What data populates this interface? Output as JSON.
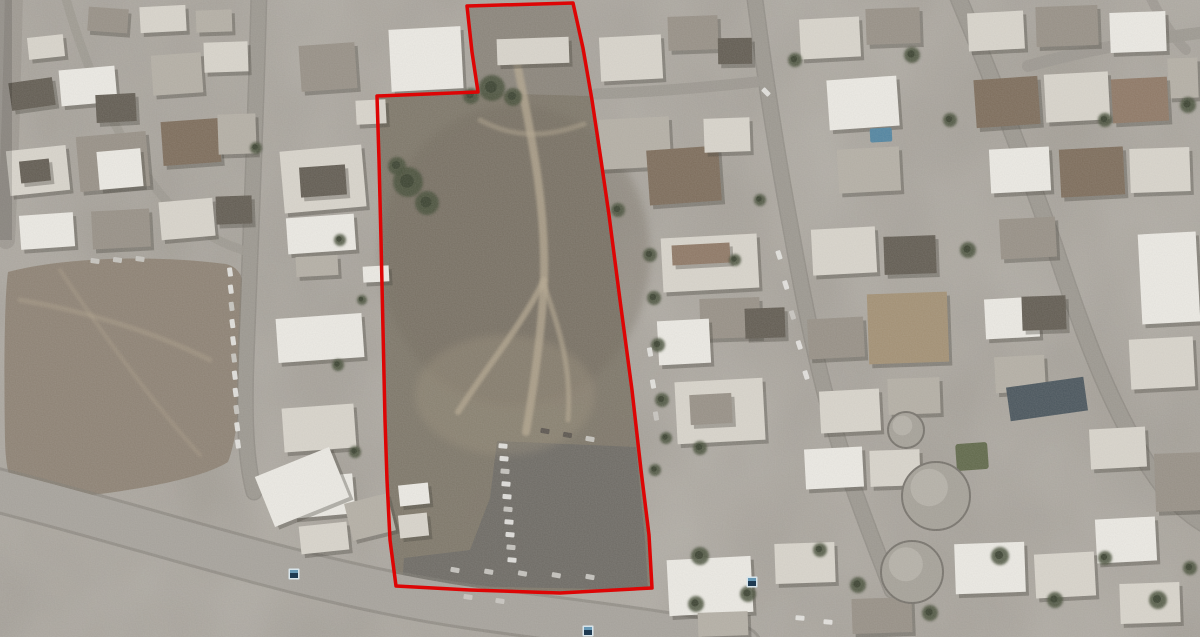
{
  "scene": {
    "width": 1200,
    "height": 637,
    "kind": "oblique-satellite-imagery",
    "palette": {
      "ground": "#a49f97",
      "road": "#9b978f",
      "road_big": "#a6a29b",
      "road_casing": "#7e7a73",
      "field": "#8c8072",
      "parcel": "#7a7265",
      "parcel_top": "#8b857b",
      "parking": "#6b6862",
      "dirt_path": "#b5a78f",
      "tree": "#434b36",
      "tree_core": "#353d2b",
      "shadow": "#3a362f",
      "w1": "#edebe5",
      "w2": "#d9d5cc",
      "g1": "#b4afa5",
      "g2": "#968f85",
      "d1": "#5f594f",
      "br": "#7b6a58",
      "br2": "#8d7663",
      "tan": "#a28f72",
      "car_light": "#e6e5e1",
      "car_mid": "#c9c7c2",
      "car_dark": "#55504a",
      "boundary_red": "#dd0505",
      "marker_fill": "#1e3a52",
      "marker_border": "#d8e4ea",
      "marker_highlight": "#6fa3c0",
      "pool_blue": "#4e83a0",
      "slate_roof": "#46525a",
      "green_patch": "#5d6647",
      "tank": "#a5a198",
      "tank_rim": "#75716a"
    },
    "boundary": {
      "name": "red-parcel-boundary",
      "stroke_width": 3.5,
      "points": [
        [
          467,
          6
        ],
        [
          573,
          3
        ],
        [
          583,
          48
        ],
        [
          592,
          100
        ],
        [
          601,
          160
        ],
        [
          609,
          215
        ],
        [
          620,
          300
        ],
        [
          632,
          390
        ],
        [
          641,
          470
        ],
        [
          649,
          535
        ],
        [
          652,
          588
        ],
        [
          560,
          593
        ],
        [
          470,
          590
        ],
        [
          396,
          586
        ],
        [
          390,
          540
        ],
        [
          387,
          480
        ],
        [
          385,
          420
        ],
        [
          383,
          330
        ],
        [
          381,
          240
        ],
        [
          379,
          160
        ],
        [
          377,
          96
        ],
        [
          478,
          92
        ],
        [
          472,
          52
        ]
      ]
    },
    "markers": [
      {
        "name": "placemark-1",
        "x": 294,
        "y": 574
      },
      {
        "name": "placemark-2",
        "x": 588,
        "y": 631
      },
      {
        "name": "placemark-3",
        "x": 752,
        "y": 582
      }
    ],
    "regions": [
      {
        "name": "dirt-field-left",
        "fill": "field",
        "opacity": 1,
        "path": "M8,272 C60,258 150,254 226,264 C242,268 246,282 245,310 C243,370 240,430 228,462 C200,480 120,494 40,500 C18,500 6,488 5,440 C4,380 4,300 8,272 Z"
      },
      {
        "name": "parcel-interior",
        "fill": "parcel",
        "opacity": 0.96,
        "path": "M467,6 L573,3 L583,48 L592,100 L601,160 L609,215 L620,300 L632,390 L641,470 L649,535 L652,588 L560,593 L470,590 L396,586 L390,540 L387,480 L385,420 L383,330 L381,240 L379,160 L377,96 L478,92 L472,52 Z"
      },
      {
        "name": "parcel-top-yard",
        "fill": "parcel_top",
        "opacity": 0.9,
        "path": "M468,7 L572,4 L590,96 L479,93 Z"
      },
      {
        "name": "parking-lot",
        "fill": "parking",
        "opacity": 1,
        "path": "M497,441 L636,447 L645,540 L648,590 L402,585 L404,558 L470,550 L490,498 Z"
      }
    ],
    "roads": [
      {
        "name": "left-edge-lane",
        "width": 18,
        "casing": 0,
        "opacity": 0.9,
        "path": "M14,-8 C12,80 10,160 6,240"
      },
      {
        "name": "left-street",
        "width": 14,
        "casing": 3,
        "opacity": 1,
        "path": "M259,-8 C256,120 250,250 246,360 C244,420 246,462 254,492"
      },
      {
        "name": "topleft-diagonal-street",
        "width": 9,
        "casing": 0,
        "opacity": 0.8,
        "path": "M64,-8 C86,70 120,150 170,205 C195,230 225,246 250,252"
      },
      {
        "name": "main-boulevard",
        "width": 40,
        "casing": 6,
        "opacity": 1,
        "big": true,
        "path": "M-12,488 C140,525 300,582 470,607 C580,623 660,630 740,648"
      },
      {
        "name": "center-right-street",
        "width": 14,
        "casing": 3,
        "opacity": 1,
        "path": "M754,-8 C764,70 776,150 792,235 C808,325 824,400 848,472 C862,514 876,548 892,590"
      },
      {
        "name": "cross-street",
        "width": 11,
        "casing": 0,
        "opacity": 0.95,
        "path": "M596,94 C648,92 700,88 756,82"
      },
      {
        "name": "far-right-street",
        "width": 15,
        "casing": 3,
        "opacity": 1,
        "path": "M956,-8 C992,78 1024,160 1054,245 C1082,330 1108,402 1150,468 C1168,496 1186,514 1208,526"
      },
      {
        "name": "topright-street",
        "width": 12,
        "casing": 0,
        "opacity": 0.95,
        "path": "M1028,66 C1086,50 1140,40 1208,32"
      },
      {
        "name": "topright-corner-lane",
        "width": 10,
        "casing": 0,
        "opacity": 0.85,
        "path": "M1148,-8 C1158,14 1170,34 1186,50"
      }
    ],
    "dirt_paths": [
      {
        "width": 8,
        "opacity": 0.75,
        "path": "M516,58 C530,130 546,200 544,280 C542,330 534,385 526,432"
      },
      {
        "width": 6,
        "opacity": 0.7,
        "path": "M544,280 C522,325 488,365 458,412"
      },
      {
        "width": 5,
        "opacity": 0.6,
        "path": "M544,285 C560,330 572,370 568,420"
      },
      {
        "width": 5,
        "opacity": 0.45,
        "path": "M480,120 C520,142 556,134 584,124"
      },
      {
        "width": 5,
        "opacity": 0.35,
        "path": "M20,300 C80,310 150,330 210,360"
      },
      {
        "width": 4,
        "opacity": 0.3,
        "path": "M60,270 C100,330 150,400 200,455"
      }
    ],
    "buildings": [
      [
        28,
        36,
        36,
        22,
        -6,
        "w2"
      ],
      [
        88,
        8,
        40,
        24,
        4,
        "g2"
      ],
      [
        140,
        6,
        46,
        26,
        -3,
        "w2"
      ],
      [
        196,
        10,
        36,
        22,
        -2,
        "g1"
      ],
      [
        10,
        80,
        44,
        28,
        -8,
        "d1"
      ],
      [
        60,
        68,
        56,
        36,
        -5,
        "w1"
      ],
      [
        96,
        94,
        40,
        28,
        -3,
        "d1"
      ],
      [
        152,
        54,
        50,
        40,
        -4,
        "g1"
      ],
      [
        204,
        42,
        44,
        30,
        -2,
        "w2"
      ],
      [
        8,
        148,
        60,
        45,
        -6,
        "w2"
      ],
      [
        20,
        160,
        30,
        22,
        -6,
        "d1"
      ],
      [
        78,
        134,
        70,
        55,
        -5,
        "g2"
      ],
      [
        98,
        150,
        44,
        38,
        -5,
        "w1"
      ],
      [
        162,
        120,
        58,
        44,
        -4,
        "br"
      ],
      [
        218,
        114,
        38,
        40,
        -2,
        "g1"
      ],
      [
        20,
        214,
        54,
        34,
        -4,
        "w1"
      ],
      [
        92,
        210,
        58,
        38,
        -3,
        "g2"
      ],
      [
        160,
        200,
        54,
        38,
        -5,
        "w2"
      ],
      [
        216,
        196,
        36,
        28,
        -2,
        "d1"
      ],
      [
        390,
        28,
        72,
        62,
        -3,
        "w1"
      ],
      [
        300,
        44,
        56,
        46,
        -4,
        "g2"
      ],
      [
        356,
        100,
        30,
        24,
        -3,
        "w2"
      ],
      [
        282,
        148,
        82,
        62,
        -5,
        "w2"
      ],
      [
        300,
        166,
        46,
        30,
        -4,
        "d1"
      ],
      [
        287,
        216,
        68,
        36,
        -4,
        "w1"
      ],
      [
        296,
        256,
        42,
        20,
        -3,
        "g1"
      ],
      [
        277,
        316,
        86,
        44,
        -4,
        "w1"
      ],
      [
        283,
        406,
        72,
        44,
        -4,
        "w2"
      ],
      [
        292,
        476,
        62,
        40,
        -5,
        "w1"
      ],
      [
        300,
        524,
        48,
        28,
        -6,
        "w2"
      ],
      [
        363,
        266,
        26,
        16,
        -3,
        "w1"
      ],
      [
        262,
        460,
        80,
        54,
        -22,
        "w1"
      ],
      [
        348,
        498,
        44,
        38,
        -14,
        "g1"
      ],
      [
        399,
        484,
        30,
        21,
        -6,
        "w1"
      ],
      [
        399,
        514,
        29,
        23,
        -6,
        "w2"
      ],
      [
        497,
        38,
        72,
        26,
        -2,
        "w2"
      ],
      [
        600,
        36,
        62,
        44,
        -3,
        "w2"
      ],
      [
        668,
        16,
        50,
        34,
        -2,
        "g2"
      ],
      [
        600,
        118,
        70,
        50,
        -3,
        "g1"
      ],
      [
        648,
        148,
        72,
        55,
        -4,
        "br"
      ],
      [
        704,
        118,
        46,
        34,
        -2,
        "w2"
      ],
      [
        718,
        38,
        34,
        26,
        -1,
        "d1"
      ],
      [
        662,
        236,
        96,
        54,
        -3,
        "w2"
      ],
      [
        672,
        244,
        58,
        20,
        -3,
        "br2"
      ],
      [
        700,
        298,
        60,
        40,
        -2,
        "g2"
      ],
      [
        658,
        320,
        52,
        44,
        -3,
        "w1"
      ],
      [
        676,
        380,
        88,
        62,
        -3,
        "w2"
      ],
      [
        690,
        394,
        42,
        30,
        -3,
        "g2"
      ],
      [
        745,
        308,
        40,
        30,
        -2,
        "d1"
      ],
      [
        800,
        18,
        60,
        40,
        -3,
        "w2"
      ],
      [
        866,
        8,
        54,
        36,
        -2,
        "g2"
      ],
      [
        828,
        78,
        70,
        50,
        -4,
        "w1"
      ],
      [
        838,
        148,
        62,
        44,
        -3,
        "g1"
      ],
      [
        812,
        228,
        64,
        46,
        -3,
        "w2"
      ],
      [
        884,
        236,
        52,
        38,
        -2,
        "d1"
      ],
      [
        808,
        318,
        56,
        40,
        -3,
        "g2"
      ],
      [
        868,
        293,
        80,
        70,
        -2,
        "tan"
      ],
      [
        820,
        390,
        60,
        42,
        -3,
        "w2"
      ],
      [
        888,
        378,
        52,
        36,
        -2,
        "g1"
      ],
      [
        805,
        448,
        58,
        40,
        -3,
        "w1"
      ],
      [
        870,
        450,
        50,
        36,
        -2,
        "w2"
      ],
      [
        968,
        12,
        56,
        38,
        -3,
        "w2"
      ],
      [
        1036,
        6,
        62,
        40,
        -2,
        "g2"
      ],
      [
        1110,
        12,
        56,
        40,
        -2,
        "w1"
      ],
      [
        1168,
        58,
        30,
        40,
        -2,
        "g1"
      ],
      [
        975,
        78,
        64,
        48,
        -4,
        "br"
      ],
      [
        1045,
        73,
        64,
        48,
        -3,
        "w2"
      ],
      [
        1112,
        78,
        56,
        44,
        -3,
        "br2"
      ],
      [
        990,
        148,
        60,
        44,
        -3,
        "w1"
      ],
      [
        1060,
        148,
        64,
        48,
        -3,
        "br"
      ],
      [
        1130,
        148,
        60,
        44,
        -2,
        "w2"
      ],
      [
        1000,
        218,
        56,
        40,
        -3,
        "g2"
      ],
      [
        1140,
        233,
        58,
        90,
        -3,
        "w1"
      ],
      [
        1130,
        338,
        64,
        50,
        -3,
        "w2"
      ],
      [
        985,
        298,
        54,
        40,
        -3,
        "w1"
      ],
      [
        1022,
        296,
        44,
        34,
        -2,
        "d1"
      ],
      [
        995,
        356,
        50,
        36,
        -3,
        "g1"
      ],
      [
        1090,
        428,
        56,
        40,
        -3,
        "w2"
      ],
      [
        1155,
        453,
        48,
        58,
        -2,
        "g2"
      ],
      [
        1096,
        518,
        60,
        44,
        -3,
        "w1"
      ],
      [
        668,
        558,
        84,
        56,
        -3,
        "w1"
      ],
      [
        775,
        543,
        60,
        40,
        -2,
        "w2"
      ],
      [
        955,
        543,
        70,
        50,
        -2,
        "w1"
      ],
      [
        1035,
        553,
        60,
        44,
        -3,
        "w2"
      ],
      [
        1120,
        583,
        60,
        40,
        -2,
        "w2"
      ],
      [
        852,
        598,
        60,
        35,
        -2,
        "g2"
      ],
      [
        698,
        612,
        50,
        24,
        -2,
        "g1"
      ]
    ],
    "features": {
      "slate_roof_rect": [
        1008,
        382,
        78,
        34,
        -8
      ],
      "pool": [
        870,
        128,
        22,
        14,
        -3
      ],
      "green_patch": [
        956,
        443,
        32,
        27,
        -4
      ],
      "tanks": [
        [
          936,
          496,
          34
        ],
        [
          912,
          572,
          31
        ],
        [
          906,
          430,
          18
        ]
      ]
    },
    "trees": [
      [
        492,
        88,
        13
      ],
      [
        513,
        97,
        9
      ],
      [
        471,
        96,
        8
      ],
      [
        408,
        182,
        15
      ],
      [
        427,
        203,
        12
      ],
      [
        397,
        166,
        9
      ],
      [
        650,
        255,
        7
      ],
      [
        654,
        298,
        7
      ],
      [
        658,
        345,
        7
      ],
      [
        662,
        400,
        7
      ],
      [
        666,
        438,
        6
      ],
      [
        700,
        556,
        9
      ],
      [
        748,
        594,
        8
      ],
      [
        696,
        604,
        8
      ],
      [
        820,
        550,
        7
      ],
      [
        858,
        585,
        8
      ],
      [
        930,
        613,
        8
      ],
      [
        1000,
        556,
        9
      ],
      [
        1055,
        600,
        8
      ],
      [
        1105,
        558,
        7
      ],
      [
        1158,
        600,
        9
      ],
      [
        1190,
        568,
        7
      ],
      [
        795,
        60,
        7
      ],
      [
        912,
        55,
        8
      ],
      [
        950,
        120,
        7
      ],
      [
        968,
        250,
        8
      ],
      [
        1105,
        120,
        7
      ],
      [
        1188,
        105,
        8
      ],
      [
        618,
        210,
        7
      ],
      [
        760,
        200,
        6
      ],
      [
        735,
        260,
        6
      ],
      [
        700,
        448,
        7
      ],
      [
        655,
        470,
        6
      ],
      [
        256,
        148,
        6
      ],
      [
        340,
        240,
        6
      ],
      [
        362,
        300,
        5
      ],
      [
        338,
        365,
        6
      ],
      [
        355,
        452,
        6
      ]
    ],
    "car_rows": [
      {
        "name": "left-street-parked-cars",
        "from": [
          230,
          272
        ],
        "to": [
          238,
          444
        ],
        "count": 11,
        "rot": 82,
        "color": "car_light"
      },
      {
        "name": "parking-lot-column",
        "from": [
          503,
          446
        ],
        "to": [
          512,
          560
        ],
        "count": 10,
        "rot": 5,
        "color": "car_light"
      },
      {
        "name": "parking-lot-bottom-row",
        "from": [
          455,
          570
        ],
        "to": [
          590,
          577
        ],
        "count": 5,
        "rot": 10,
        "color": "car_mid"
      },
      {
        "name": "parking-lot-top-cars",
        "from": [
          545,
          431
        ],
        "to": [
          590,
          439
        ],
        "count": 3,
        "rot": 10,
        "color": "car_dark"
      },
      {
        "name": "center-street-cars",
        "from": [
          779,
          255
        ],
        "to": [
          806,
          375
        ],
        "count": 5,
        "rot": 72,
        "color": "car_light"
      },
      {
        "name": "parcel-east-cars",
        "from": [
          650,
          352
        ],
        "to": [
          656,
          416
        ],
        "count": 3,
        "rot": 80,
        "color": "car_light"
      },
      {
        "name": "field-edge-cars",
        "from": [
          95,
          261
        ],
        "to": [
          140,
          259
        ],
        "count": 3,
        "rot": 8,
        "color": "car_mid"
      },
      {
        "name": "boulevard-cars",
        "from": [
          800,
          618
        ],
        "to": [
          828,
          622
        ],
        "count": 2,
        "rot": 5,
        "color": "car_light"
      },
      {
        "name": "boulevard-cars-2",
        "from": [
          468,
          597
        ],
        "to": [
          500,
          601
        ],
        "count": 2,
        "rot": 8,
        "color": "car_mid"
      },
      {
        "name": "cross-street-car",
        "from": [
          766,
          92
        ],
        "to": [
          766,
          92
        ],
        "count": 1,
        "rot": 45,
        "color": "car_light"
      }
    ]
  }
}
